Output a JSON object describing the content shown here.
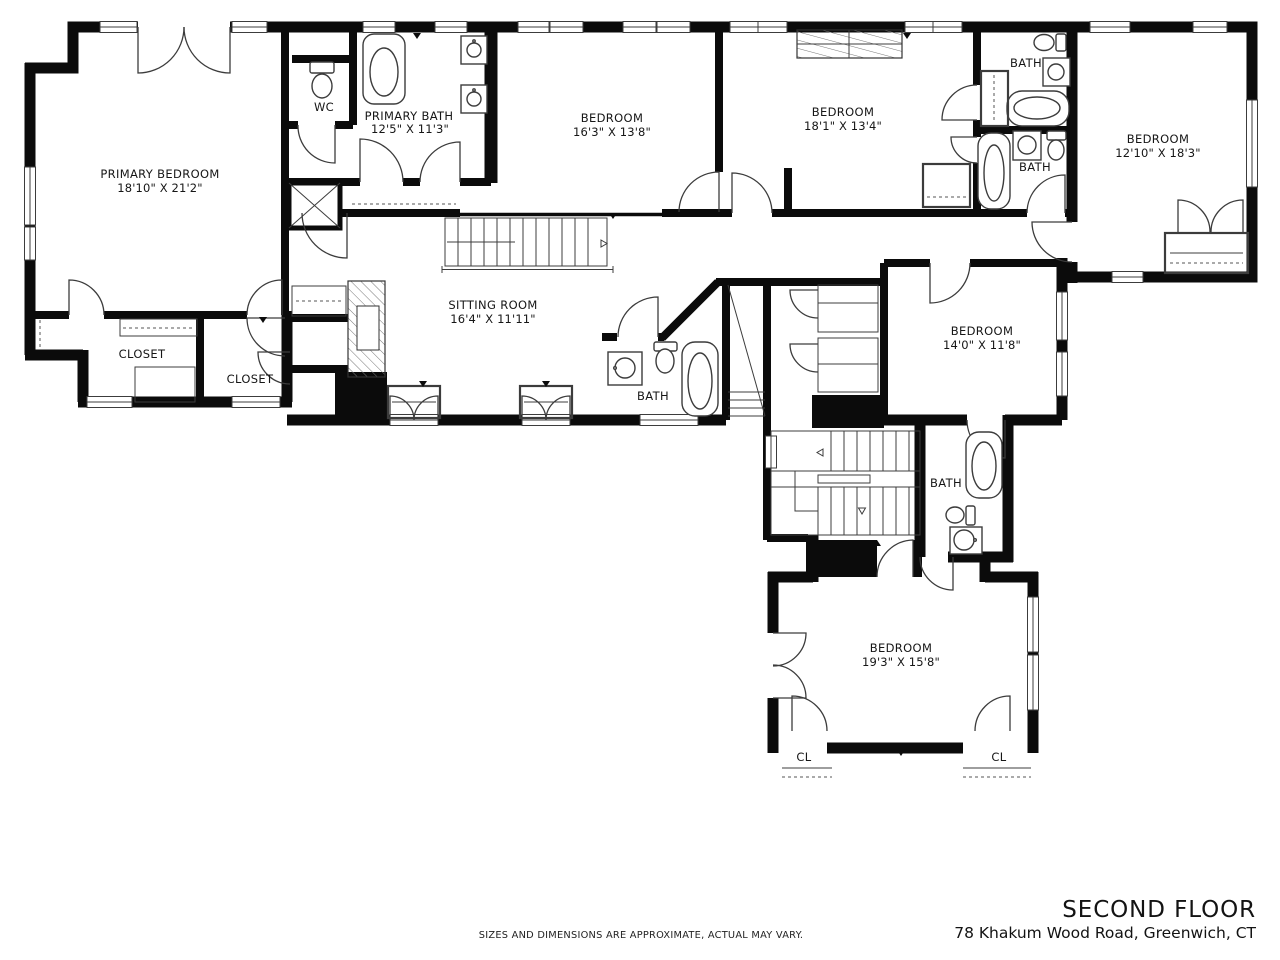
{
  "page": {
    "background": "#ffffff",
    "wall_color": "#0b0b0b",
    "line_color": "#3c3c3c"
  },
  "rooms": [
    {
      "name": "PRIMARY BEDROOM",
      "dims": "18'10\" X 21'2\""
    },
    {
      "name": "WC",
      "dims": ""
    },
    {
      "name": "PRIMARY BATH",
      "dims": "12'5\" X 11'3\""
    },
    {
      "name": "BEDROOM",
      "dims": "16'3\" X 13'8\""
    },
    {
      "name": "BEDROOM",
      "dims": "18'1\" X 13'4\""
    },
    {
      "name": "BATH",
      "dims": ""
    },
    {
      "name": "BATH",
      "dims": ""
    },
    {
      "name": "BEDROOM",
      "dims": "12'10\" X 18'3\""
    },
    {
      "name": "SITTING ROOM",
      "dims": "16'4\" X 11'11\""
    },
    {
      "name": "CLOSET",
      "dims": ""
    },
    {
      "name": "CLOSET",
      "dims": ""
    },
    {
      "name": "BATH",
      "dims": ""
    },
    {
      "name": "BEDROOM",
      "dims": "14'0\" X 11'8\""
    },
    {
      "name": "BATH",
      "dims": ""
    },
    {
      "name": "BEDROOM",
      "dims": "19'3\" X 15'8\""
    },
    {
      "name": "CL",
      "dims": ""
    },
    {
      "name": "CL",
      "dims": ""
    }
  ],
  "footer": {
    "disclaimer": "SIZES AND DIMENSIONS ARE APPROXIMATE, ACTUAL MAY VARY.",
    "floor_title": "SECOND FLOOR",
    "address": "78 Khakum Wood Road, Greenwich, CT"
  }
}
